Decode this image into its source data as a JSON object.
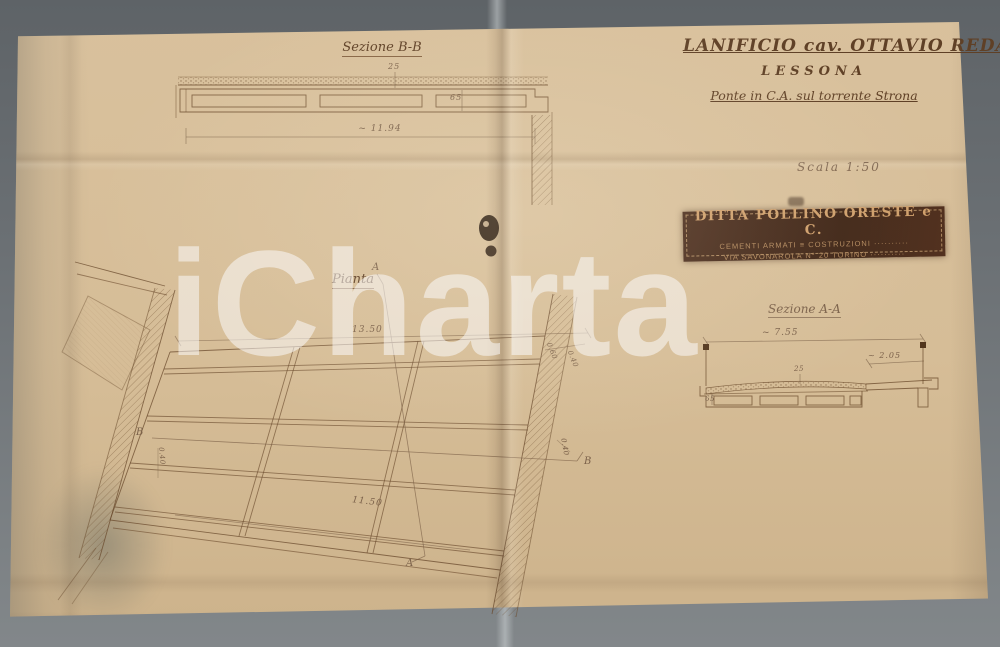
{
  "photo": {
    "watermark_text": "iCharta"
  },
  "title_block": {
    "line1": "LANIFICIO cav. OTTAVIO REDA",
    "line2": "LESSONA",
    "line3": "Ponte in C.A. sul torrente Strona",
    "scale_note": "Scala 1:50"
  },
  "stamp": {
    "line1": "DITTA POLLINO ORESTE e C.",
    "line2": "CEMENTI ARMATI ≡ COSTRUZIONI ··········",
    "line3": "VIA SAVONAROLA N° 20 TORINO ··········"
  },
  "section_bb": {
    "label": "Sezione B-B",
    "dim_slab": "25",
    "dim_depth": "65",
    "dim_span": "~ 11.94"
  },
  "plan": {
    "label": "Pianta",
    "marker_a": "A",
    "marker_b": "B",
    "dim_width": "13.50",
    "dim_skew": "11.50",
    "dim_small_1": "0.60",
    "dim_small_2": "0.40",
    "dim_small_3": "0.40",
    "dim_small_4": "0.40"
  },
  "section_aa": {
    "label": "Sezione A-A",
    "dim_total": "~ 7.55",
    "dim_sidewalk": "~ 2.05",
    "dim_slab": "25",
    "dim_depth": "65"
  }
}
